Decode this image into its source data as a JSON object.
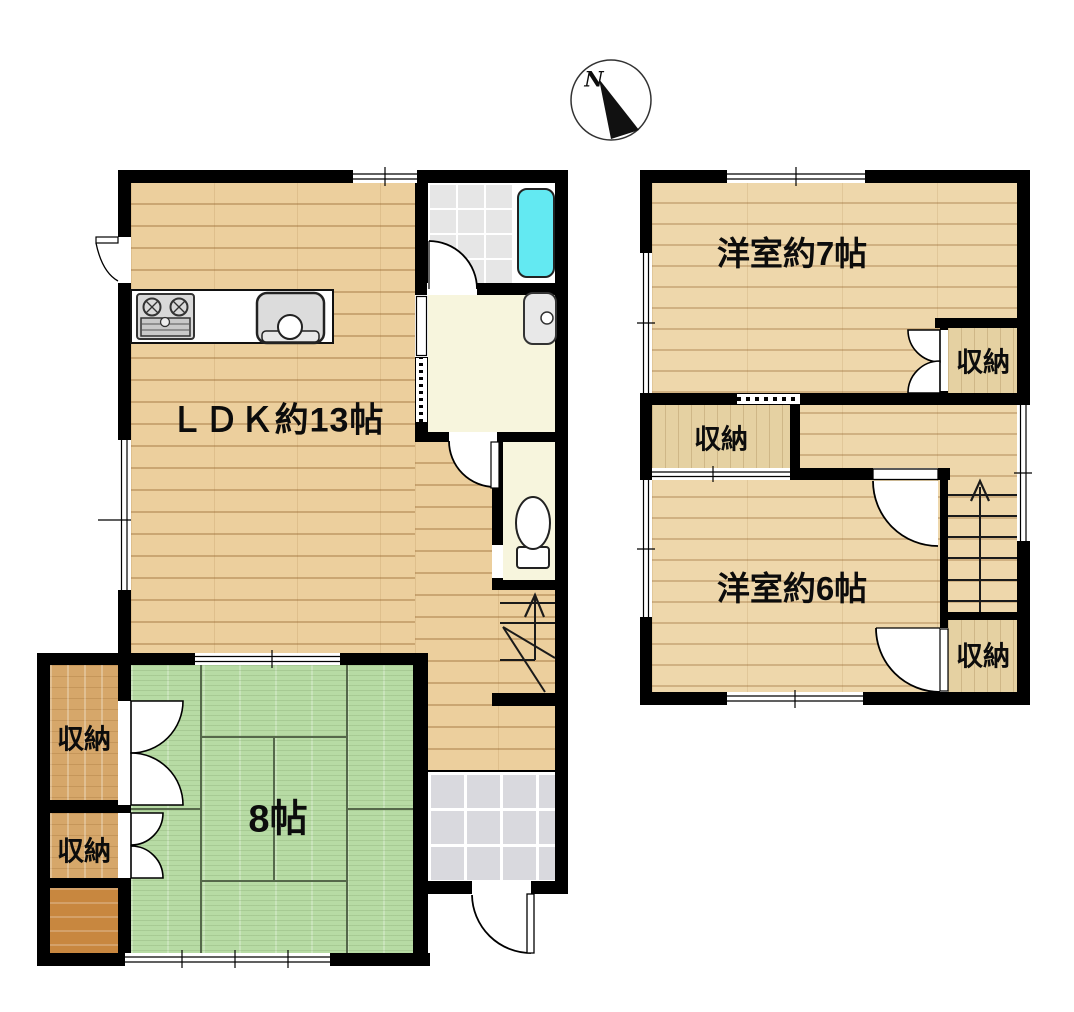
{
  "compass": {
    "north_label": "N"
  },
  "floor1": {
    "ldk_label": "ＬＤＫ約13帖",
    "tatami_label": "8帖",
    "closet_upper_label": "収納",
    "closet_lower_label": "収納"
  },
  "floor2": {
    "western_room_7_label": "洋室約7帖",
    "western_room_6_label": "洋室約6帖",
    "closet_top_right_label": "収納",
    "closet_left_label": "収納",
    "closet_bottom_right_label": "収納"
  },
  "colors": {
    "wall": "#000000",
    "wood-floor": "#eccf9d",
    "tatami": "#b7dba4",
    "tatami-line": "#55684a",
    "closet-wood-1f": "#d6a76a",
    "closet-wood-2f": "#e5d1a2",
    "alcove-wood": "#c8873f",
    "cream-floor": "#f7f5dd",
    "bath-tile": "#e6e6e6",
    "entry-tile": "#d9d9de",
    "bathtub": "#63e9f2",
    "fixture-gray": "#dcdcdc"
  }
}
